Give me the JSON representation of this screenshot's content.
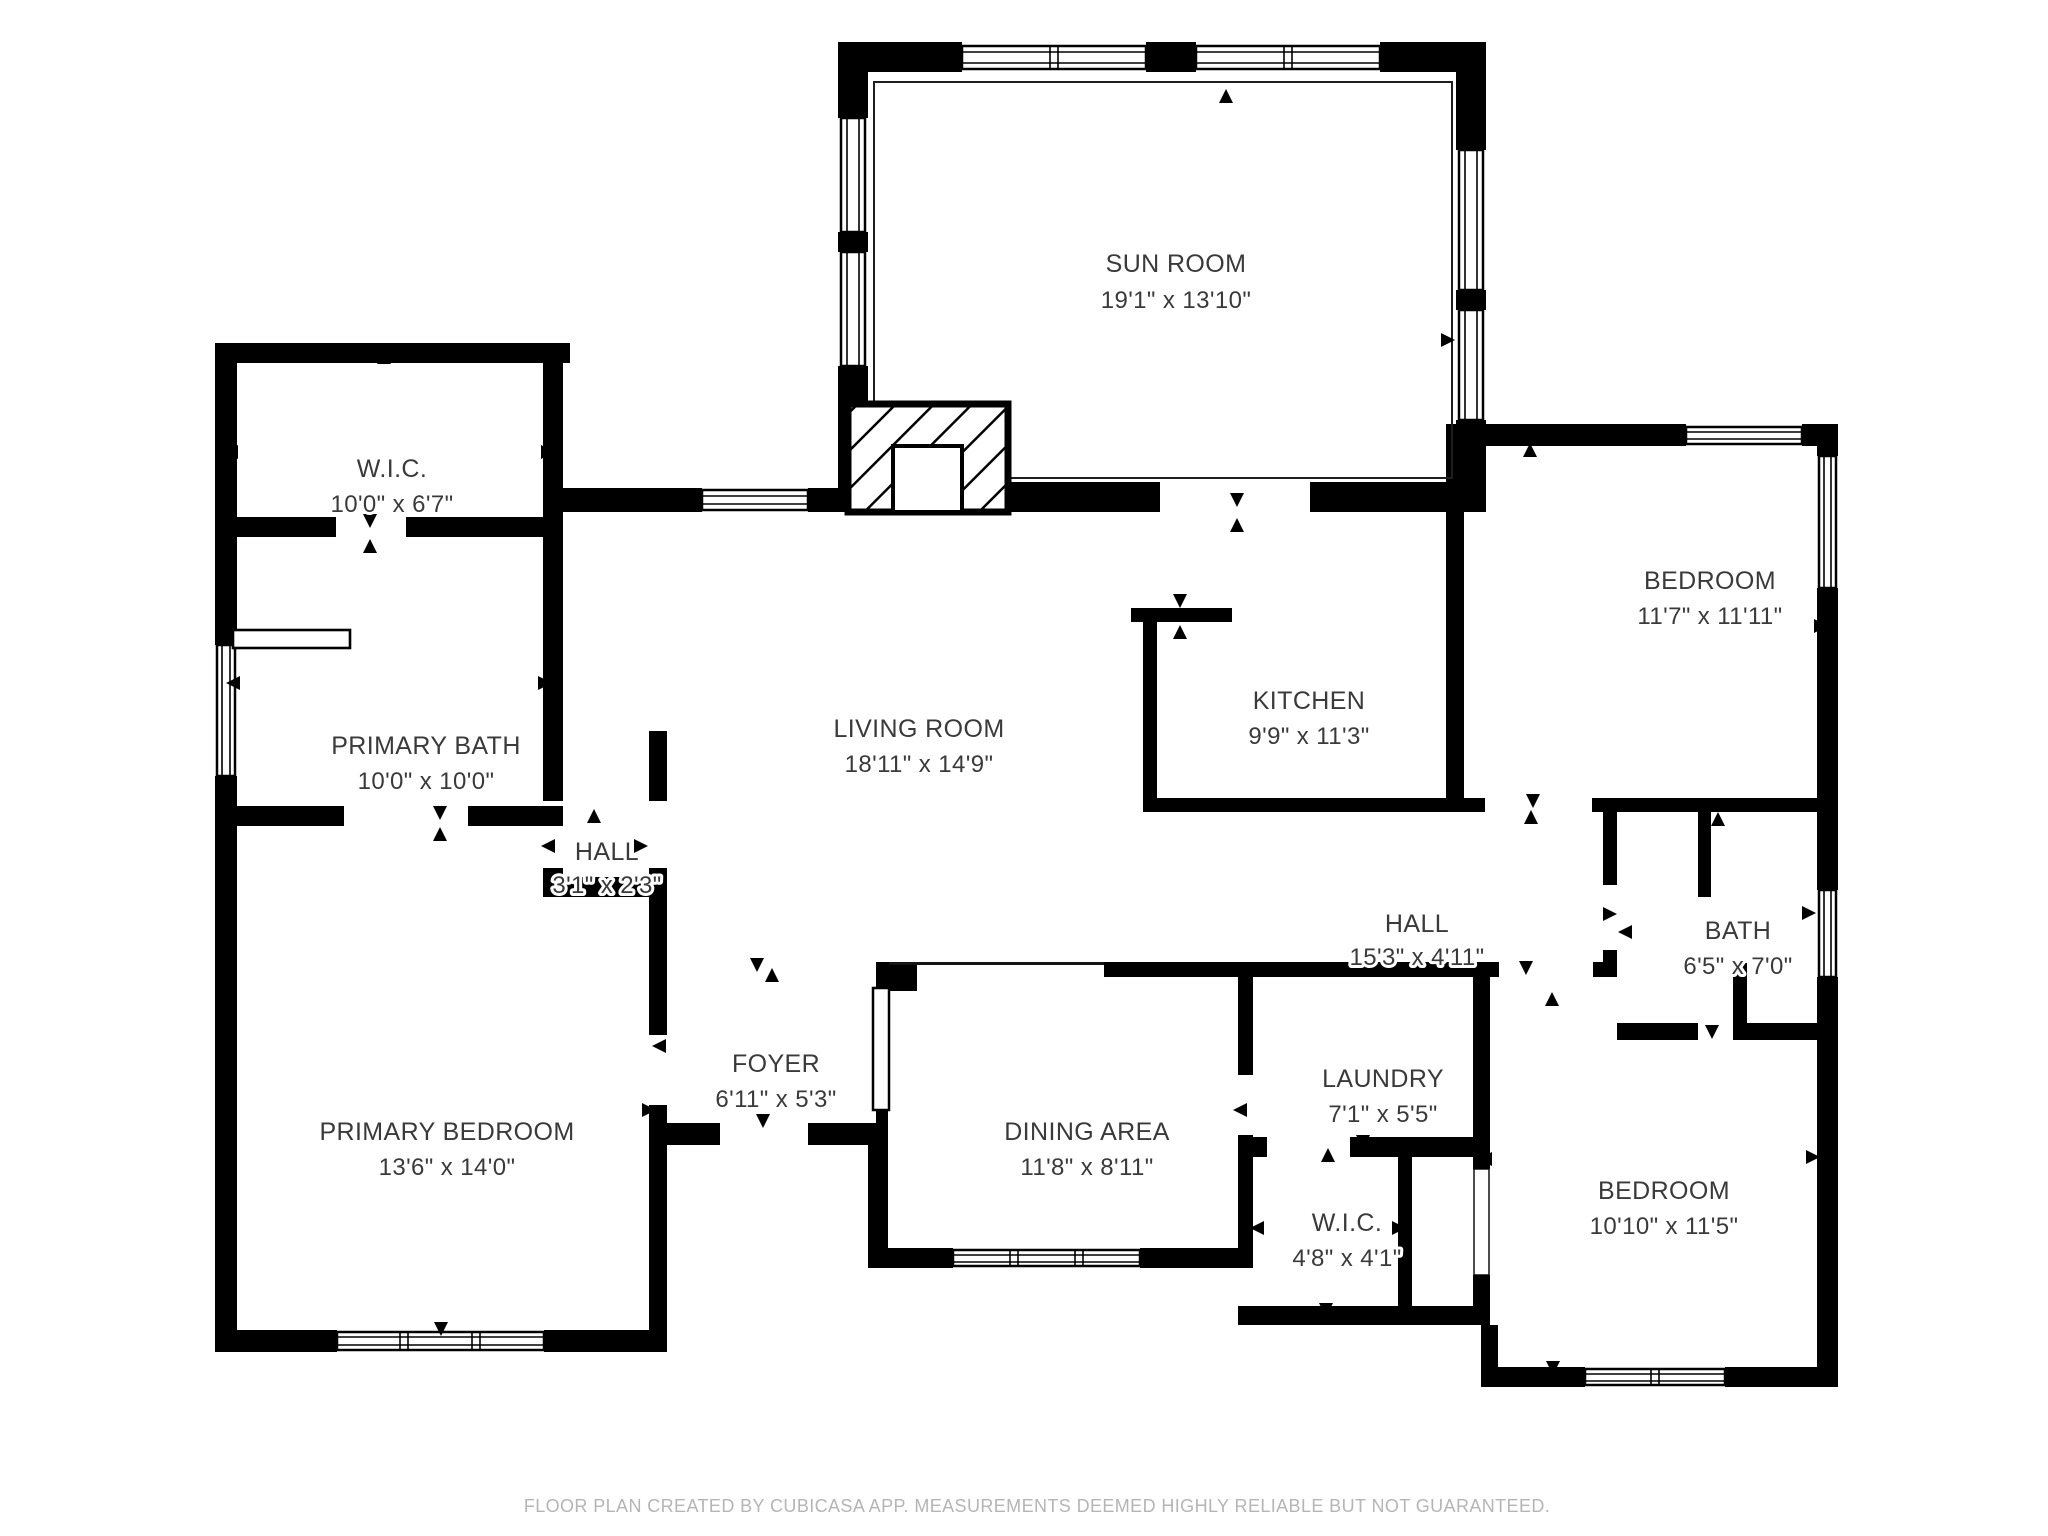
{
  "colors": {
    "wall": "#000000",
    "label": "#3a3a3a",
    "footer": "#b5b5b5",
    "background": "#ffffff",
    "thin": "#141414"
  },
  "rooms": [
    {
      "id": "sun-room",
      "name": "SUN ROOM",
      "dims": "19'1\" x 13'10\""
    },
    {
      "id": "wic-primary",
      "name": "W.I.C.",
      "dims": "10'0\" x 6'7\""
    },
    {
      "id": "bedroom-ne",
      "name": "BEDROOM",
      "dims": "11'7\" x 11'11\""
    },
    {
      "id": "primary-bath",
      "name": "PRIMARY BATH",
      "dims": "10'0\" x 10'0\""
    },
    {
      "id": "living-room",
      "name": "LIVING ROOM",
      "dims": "18'11\" x 14'9\""
    },
    {
      "id": "kitchen",
      "name": "KITCHEN",
      "dims": "9'9\" x 11'3\""
    },
    {
      "id": "hall-small",
      "name": "HALL",
      "dims": "3'1\" x 2'3\""
    },
    {
      "id": "hall",
      "name": "HALL",
      "dims": "15'3\" x 4'11\""
    },
    {
      "id": "bath",
      "name": "BATH",
      "dims": "6'5\" x 7'0\""
    },
    {
      "id": "foyer",
      "name": "FOYER",
      "dims": "6'11\" x 5'3\""
    },
    {
      "id": "primary-bedroom",
      "name": "PRIMARY BEDROOM",
      "dims": "13'6\" x 14'0\""
    },
    {
      "id": "dining-area",
      "name": "DINING AREA",
      "dims": "11'8\" x 8'11\""
    },
    {
      "id": "laundry",
      "name": "LAUNDRY",
      "dims": "7'1\" x 5'5\""
    },
    {
      "id": "wic-small",
      "name": "W.I.C.",
      "dims": "4'8\" x 4'1\""
    },
    {
      "id": "bedroom-se",
      "name": "BEDROOM",
      "dims": "10'10\" x 11'5\""
    }
  ],
  "footer": {
    "text": "FLOOR PLAN CREATED BY CUBICASA APP. MEASUREMENTS DEEMED HIGHLY RELIABLE BUT NOT GUARANTEED."
  }
}
